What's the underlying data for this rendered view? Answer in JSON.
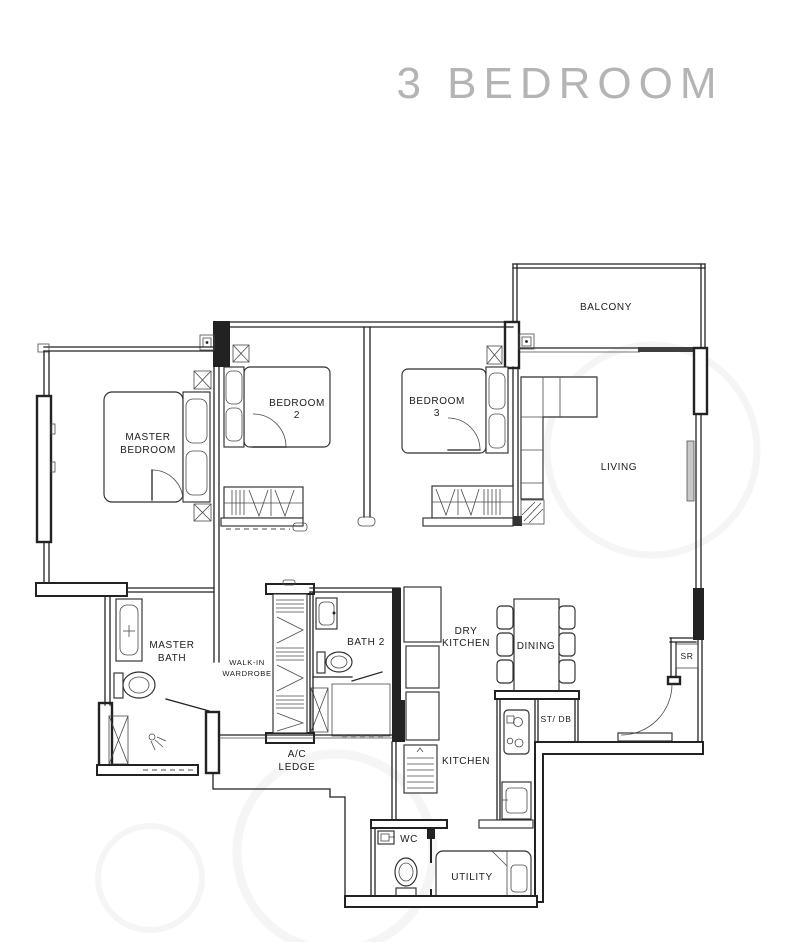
{
  "title": "3 BEDROOM",
  "colors": {
    "line": "#222222",
    "title": "#b4b4b4"
  },
  "rooms": {
    "balcony": {
      "label": "BALCONY"
    },
    "living": {
      "label": "LIVING"
    },
    "master_bedroom": {
      "line1": "MASTER",
      "line2": "BEDROOM"
    },
    "bedroom2": {
      "line1": "BEDROOM",
      "line2": "2"
    },
    "bedroom3": {
      "line1": "BEDROOM",
      "line2": "3"
    },
    "master_bath": {
      "line1": "MASTER",
      "line2": "BATH"
    },
    "walk_in_wardrobe": {
      "line1": "WALK-IN",
      "line2": "WARDROBE"
    },
    "bath2": {
      "label": "BATH 2"
    },
    "dry_kitchen": {
      "line1": "DRY",
      "line2": "KITCHEN"
    },
    "dining": {
      "label": "DINING"
    },
    "store_db": {
      "label": "ST/ DB"
    },
    "sr": {
      "label": "SR"
    },
    "kitchen": {
      "label": "KITCHEN"
    },
    "ac_ledge": {
      "line1": "A/C",
      "line2": "LEDGE"
    },
    "wc": {
      "label": "WC"
    },
    "utility": {
      "label": "UTILITY"
    }
  }
}
